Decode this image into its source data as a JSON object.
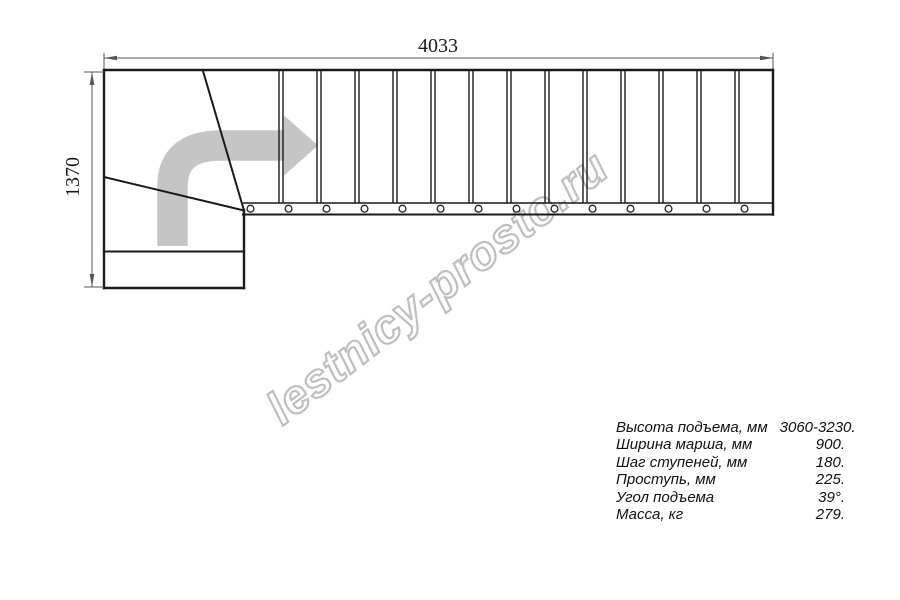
{
  "watermark": {
    "text": "lestnicy-prosto.ru"
  },
  "drawing": {
    "width_label": "4033",
    "height_label": "1370",
    "tread_count": 14,
    "baluster_count": 14
  },
  "specs": {
    "rows": [
      {
        "label": "Высота подъема, мм",
        "value": "3060-3230."
      },
      {
        "label": "Ширина марша, мм",
        "value": "900."
      },
      {
        "label": "Шаг ступеней, мм",
        "value": "180."
      },
      {
        "label": "Проступь, мм",
        "value": "225."
      },
      {
        "label": "Угол подъема",
        "value": "39°."
      },
      {
        "label": "Масса, кг",
        "value": "279."
      }
    ]
  },
  "colors": {
    "line": "#1a1a1a",
    "dimension": "#555555",
    "arrow": "#c5c5c5",
    "watermark_outline": "#bfbfbf"
  }
}
